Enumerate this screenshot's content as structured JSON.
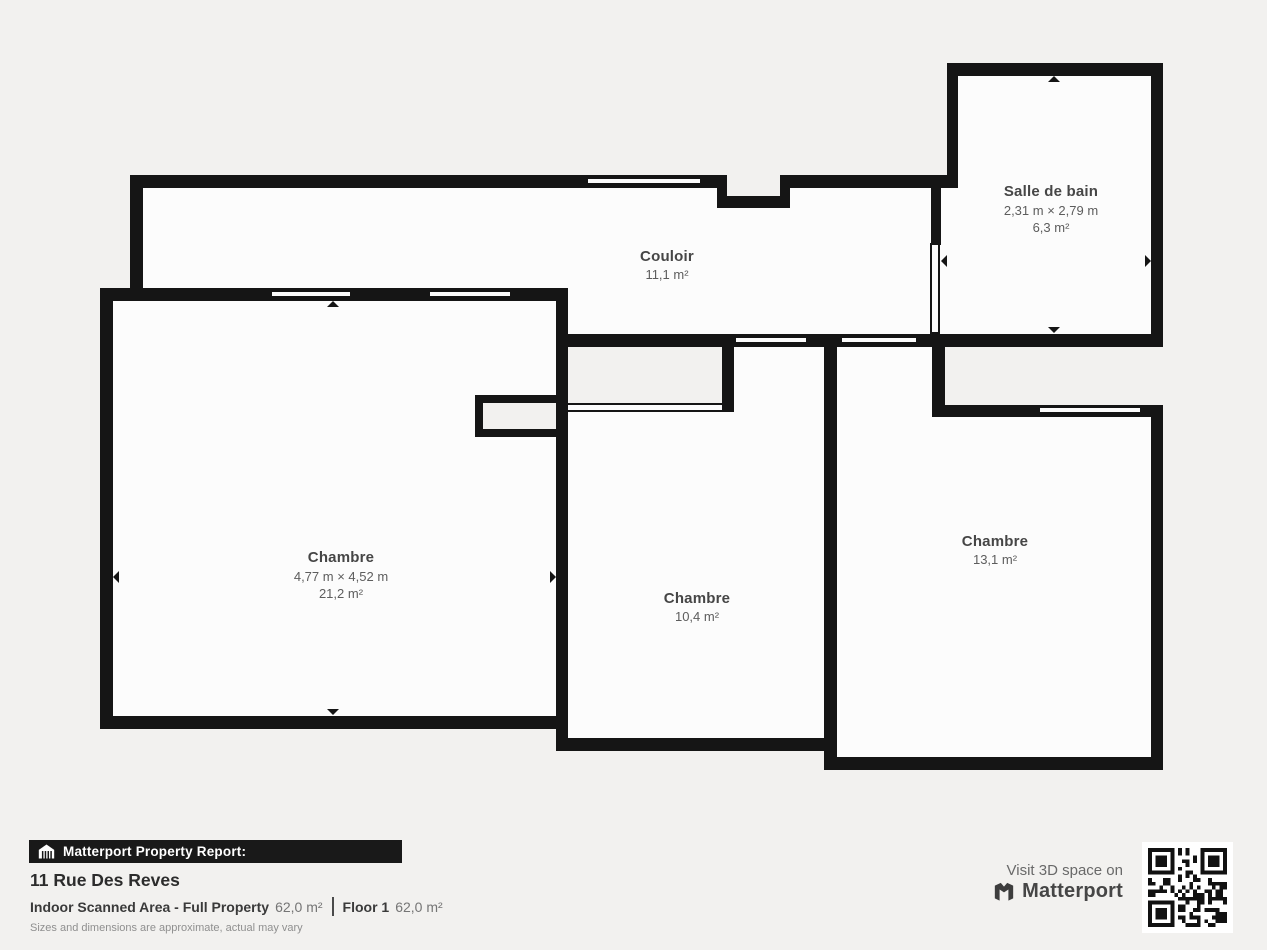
{
  "plan": {
    "rooms": [
      {
        "name": "Couloir",
        "area": "11,1 m²"
      },
      {
        "name": "Salle de bain",
        "dims": "2,31 m × 2,79 m",
        "area": "6,3 m²"
      },
      {
        "name": "Chambre",
        "dims": "4,77 m × 4,52 m",
        "area": "21,2 m²"
      },
      {
        "name": "Chambre",
        "area": "10,4 m²"
      },
      {
        "name": "Chambre",
        "area": "13,1 m²"
      }
    ]
  },
  "footer": {
    "report_banner": "Matterport Property Report:",
    "address": "11 Rue Des Reves",
    "scanned_area_label": "Indoor Scanned Area - Full Property",
    "scanned_area_value": "62,0 m²",
    "floor_label": "Floor 1",
    "floor_value": "62,0 m²",
    "disclaimer": "Sizes and dimensions are approximate, actual may vary"
  },
  "promo": {
    "visit_text": "Visit 3D space on",
    "brand": "Matterport"
  },
  "colors": {
    "wall": "#151515",
    "background": "#f2f1ef",
    "floor": "#fcfcfc",
    "banner": "#191919"
  }
}
